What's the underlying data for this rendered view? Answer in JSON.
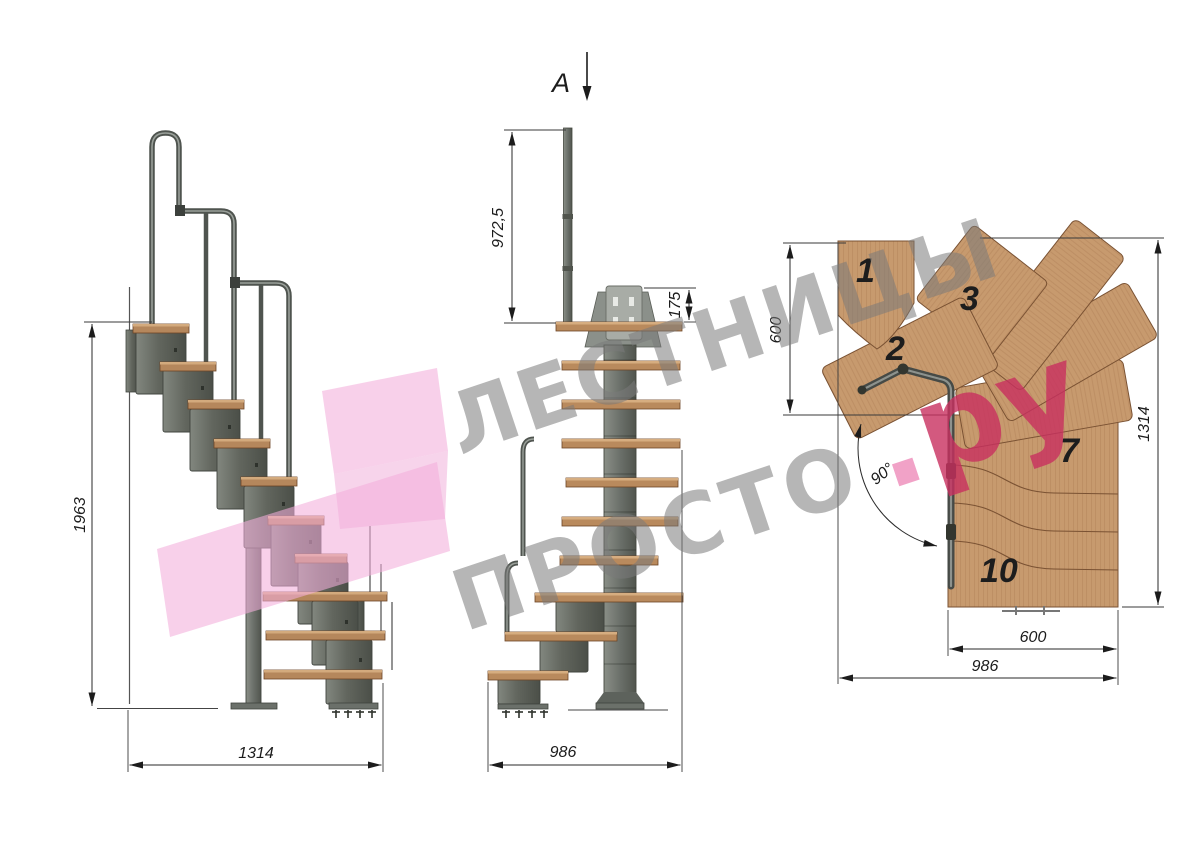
{
  "watermark": {
    "line1": "ЛЕСТНИЦЫ",
    "line2": "ПРОСТО",
    "suffix_dot": ".",
    "suffix": "ру"
  },
  "side_view": {
    "height": "1963",
    "width": "1314"
  },
  "front_view": {
    "section_label": "A",
    "post_height": "972,5",
    "bracket_height": "175",
    "width": "986"
  },
  "plan_view": {
    "left_depth": "600",
    "total_depth": "1314",
    "tread_width": "600",
    "total_width": "986",
    "turn_angle": "90°",
    "treads": {
      "t1": "1",
      "t2": "2",
      "t3": "3",
      "t7": "7",
      "t10": "10"
    }
  },
  "colors": {
    "wood": "#c79a6e",
    "metal": "#6e736e",
    "watermark_gray": "#7a7a7a",
    "watermark_pink": "#c8305f",
    "arrow_pink": "#f3aeda"
  }
}
